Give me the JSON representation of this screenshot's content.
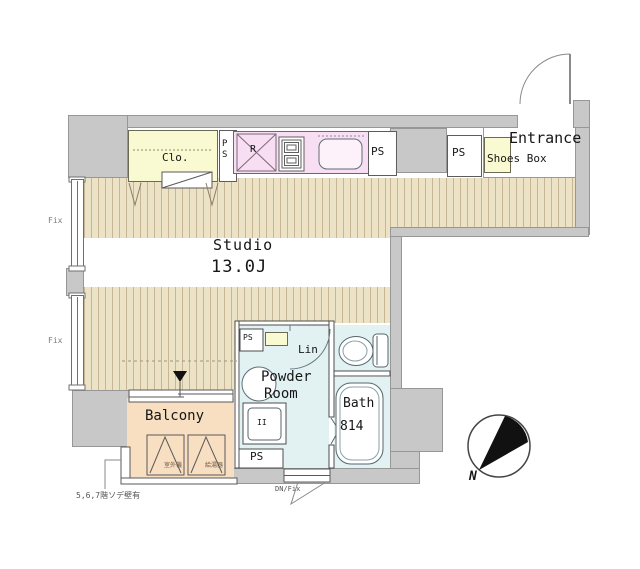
{
  "plan": {
    "rooms": {
      "studio": {
        "name": "Studio",
        "area": "13.0J"
      },
      "closet": {
        "label": "Clo."
      },
      "kitchen": {
        "fridge_label": "R"
      },
      "entrance": {
        "label": "Entrance"
      },
      "shoes_box": {
        "label": "Shoes Box"
      },
      "powder_room": {
        "name_line1": "Powder",
        "name_line2": "Room",
        "washer_mark": "II"
      },
      "linen": {
        "label": "Lin"
      },
      "bath": {
        "label": "Bath",
        "size": "814"
      },
      "balcony": {
        "label": "Balcony",
        "outdoor_unit": "室外機",
        "water_heater": "給湯器"
      }
    },
    "labels": {
      "ps": "PS",
      "fix": "Fix",
      "dn_fix": "DN/Fix",
      "north": "N",
      "wall_note": "5,6,7階ソデ壁有"
    },
    "colors": {
      "wall": "#c8c8c8",
      "flooring": "#ece3c6",
      "flooring_stripe": "#c6b695",
      "closet_yellow": "#fafad2",
      "kitchen_pink": "#f7def2",
      "wet_area_blue": "#e2f2f3",
      "balcony_peach": "#f8dfc2"
    }
  }
}
